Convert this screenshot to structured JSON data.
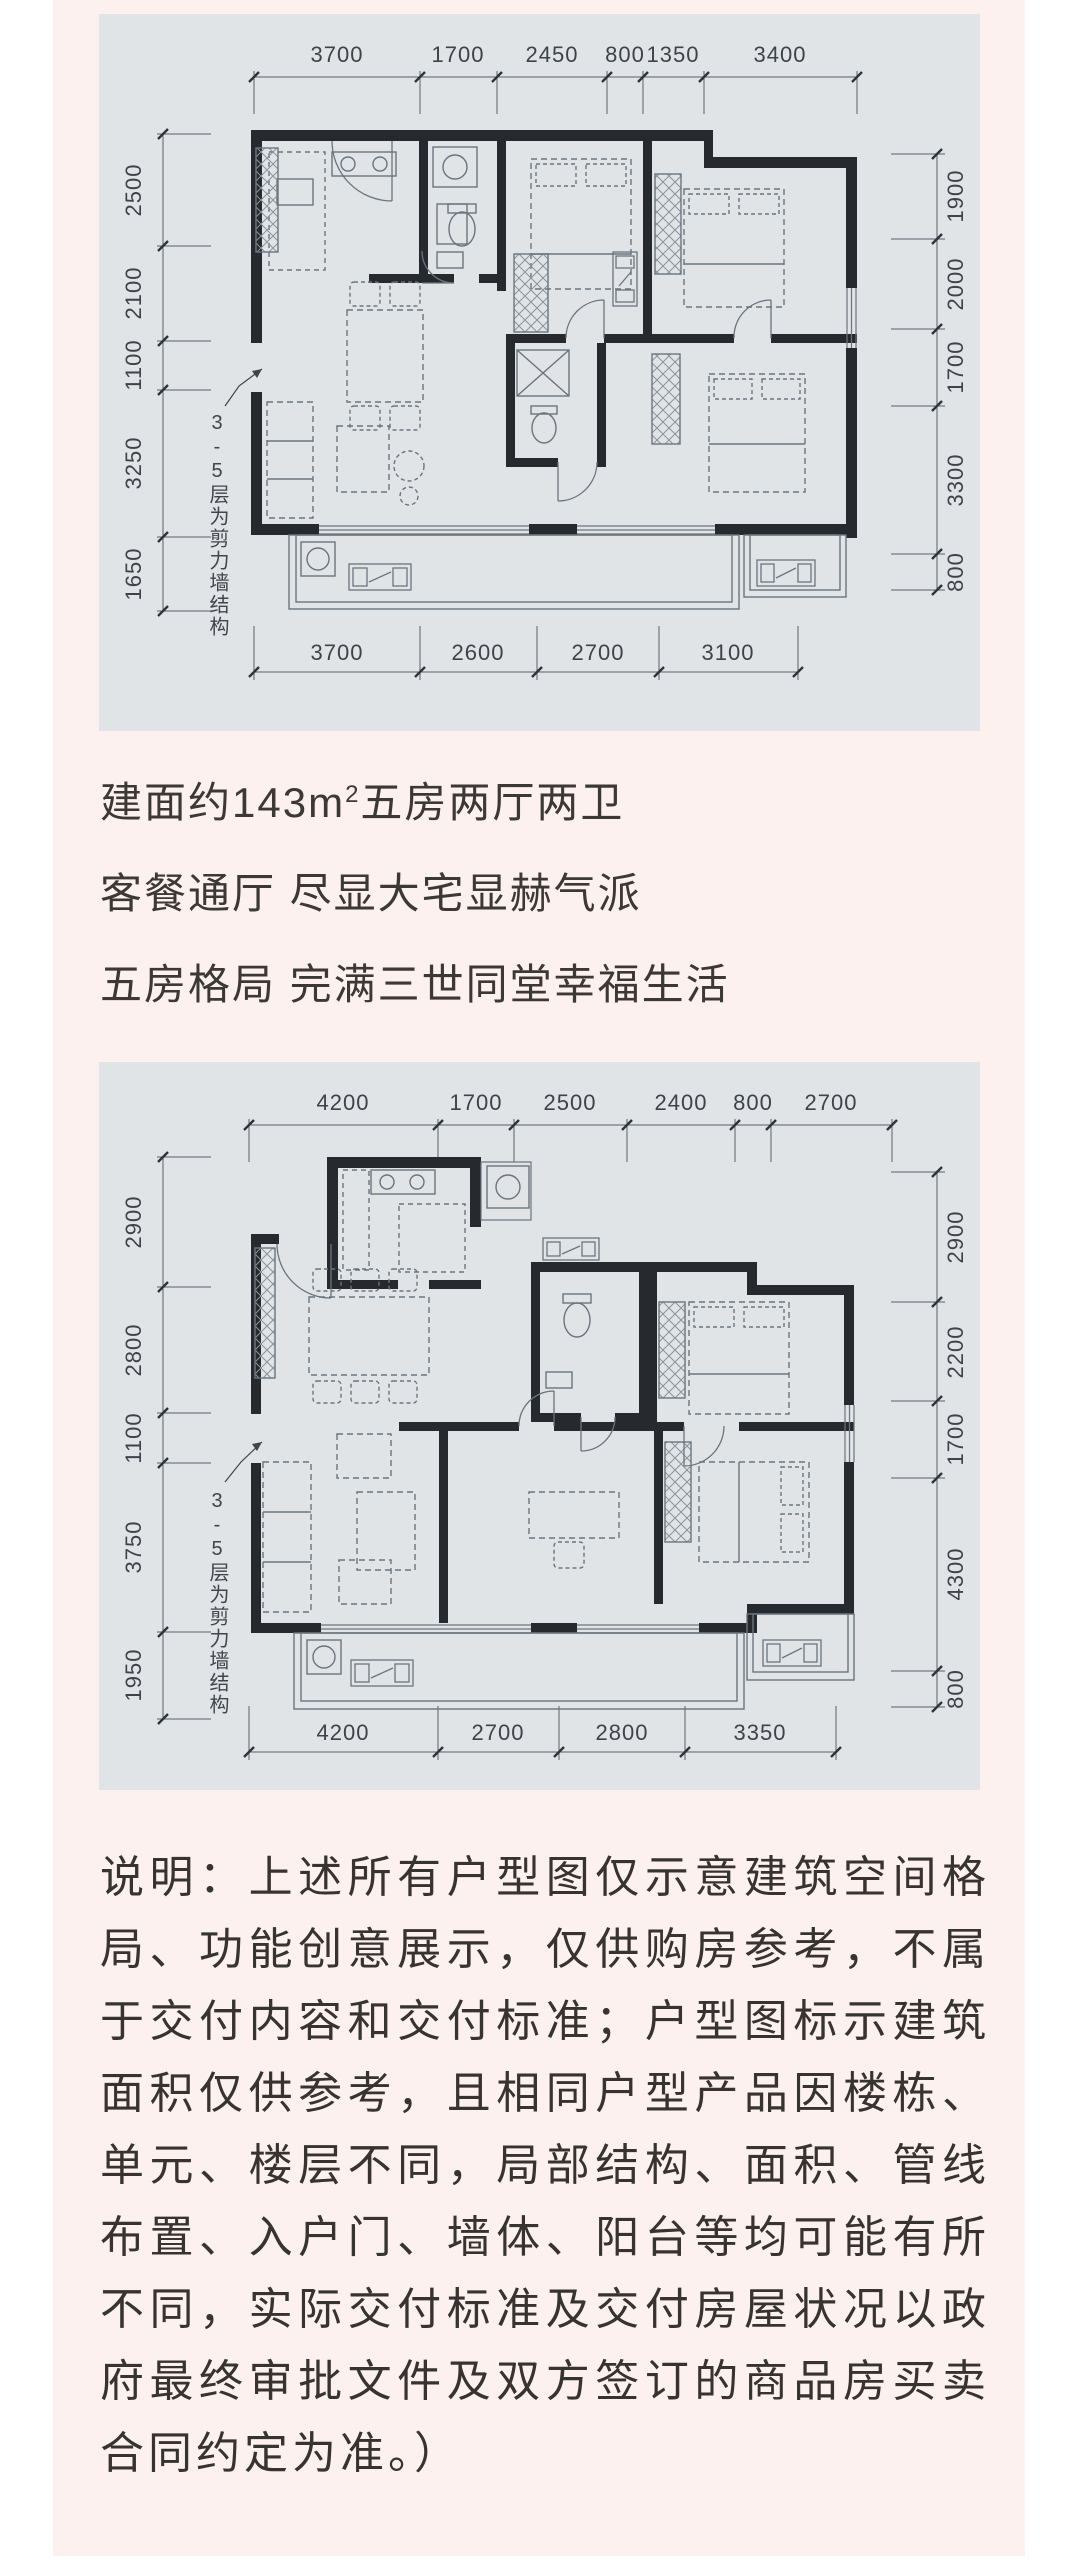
{
  "page": {
    "background": "#ffffff",
    "panel_color": "#fdf1ef",
    "card_color": "#e0e4e7",
    "wall_color": "#26292e",
    "line_color": "#6b747e"
  },
  "headline": {
    "line1_prefix": "建面约143m",
    "line1_sup": "2",
    "line1_suffix": "五房两厅两卫",
    "line2": "客餐通厅 尽显大宅显赫气派",
    "line3": "五房格局 完满三世同堂幸福生活"
  },
  "plan1": {
    "dims_top": [
      "3700",
      "1700",
      "2450",
      "800",
      "1350",
      "3400"
    ],
    "dims_bottom": [
      "3700",
      "2600",
      "2700",
      "3100"
    ],
    "dims_left": [
      "2500",
      "2100",
      "1100",
      "3250",
      "1650"
    ],
    "dims_right": [
      "1900",
      "2000",
      "1700",
      "3300",
      "800"
    ],
    "annotation": "3-5层为剪力墙结构"
  },
  "plan2": {
    "dims_top": [
      "4200",
      "1700",
      "2500",
      "2400",
      "800",
      "2700"
    ],
    "dims_bottom": [
      "4200",
      "2700",
      "2800",
      "3350"
    ],
    "dims_left": [
      "2900",
      "2800",
      "1100",
      "3750",
      "1950"
    ],
    "dims_right": [
      "2900",
      "2200",
      "1700",
      "4300",
      "800"
    ],
    "annotation": "3-5层为剪力墙结构"
  },
  "disclaimer": {
    "lines": [
      "说明：上述所有户型图仅示意建筑空间格",
      "局、功能创意展示，仅供购房参考，不属",
      "于交付内容和交付标准；户型图标示建筑",
      "面积仅供参考，且相同户型产品因楼栋、",
      "单元、楼层不同，局部结构、面积、管线",
      "布置、入户门、墙体、阳台等均可能有所",
      "不同，实际交付标准及交付房屋状况以政",
      "府最终审批文件及双方签订的商品房买卖",
      "合同约定为准。）"
    ]
  }
}
